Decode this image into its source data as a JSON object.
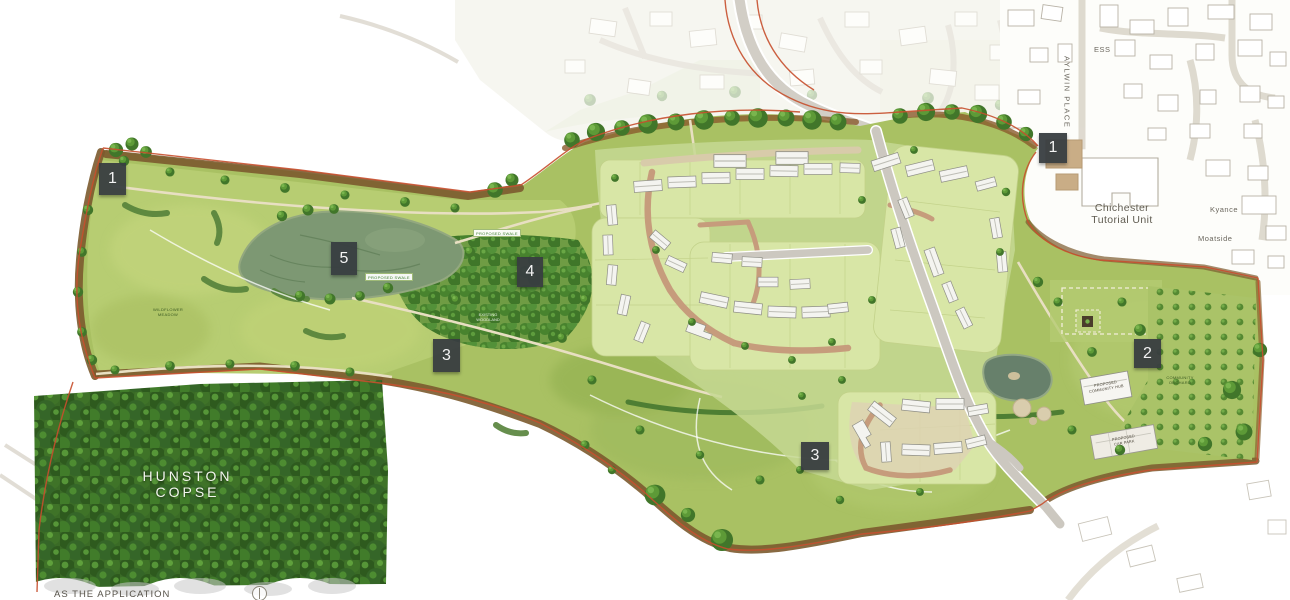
{
  "markers": [
    {
      "label": "1"
    },
    {
      "label": "1"
    },
    {
      "label": "2"
    },
    {
      "label": "3"
    },
    {
      "label": "3"
    },
    {
      "label": "4"
    },
    {
      "label": "5"
    }
  ],
  "labels": {
    "hunston_copse": {
      "line1": "HUNSTON",
      "line2": "COPSE"
    },
    "ess": "ESS",
    "street_vertical": "AYLWIN PLACE",
    "tutorial_unit": {
      "line1": "Chichester",
      "line2": "Tutorial Unit"
    },
    "kyance": "Kyance",
    "moatside": "Moatside",
    "swale_a": "PROPOSED SWALE",
    "swale_b": "PROPOSED SWALE",
    "meadow": {
      "line1": "WILDFLOWER",
      "line2": "MEADOW"
    },
    "woodland": {
      "line1": "EXISTING",
      "line2": "WOODLAND"
    },
    "orchard": {
      "line1": "COMMUNITY",
      "line2": "ORCHARD"
    },
    "community_hub": {
      "line1": "PROPOSED",
      "line2": "COMMUNITY HUB"
    },
    "car_park": {
      "line1": "PROPOSED",
      "line2": "CAR PARK"
    },
    "caption": "AS THE APPLICATION"
  },
  "colors": {
    "boundary_red": "#c74f2d",
    "marker_background": "#3a3f42",
    "meadow_green": "#b2ca6e",
    "woodland_green": "#4d8a33",
    "water_green": "#7d9873",
    "road_grey": "#ccc8c0",
    "brick_street": "#c69c7c"
  }
}
